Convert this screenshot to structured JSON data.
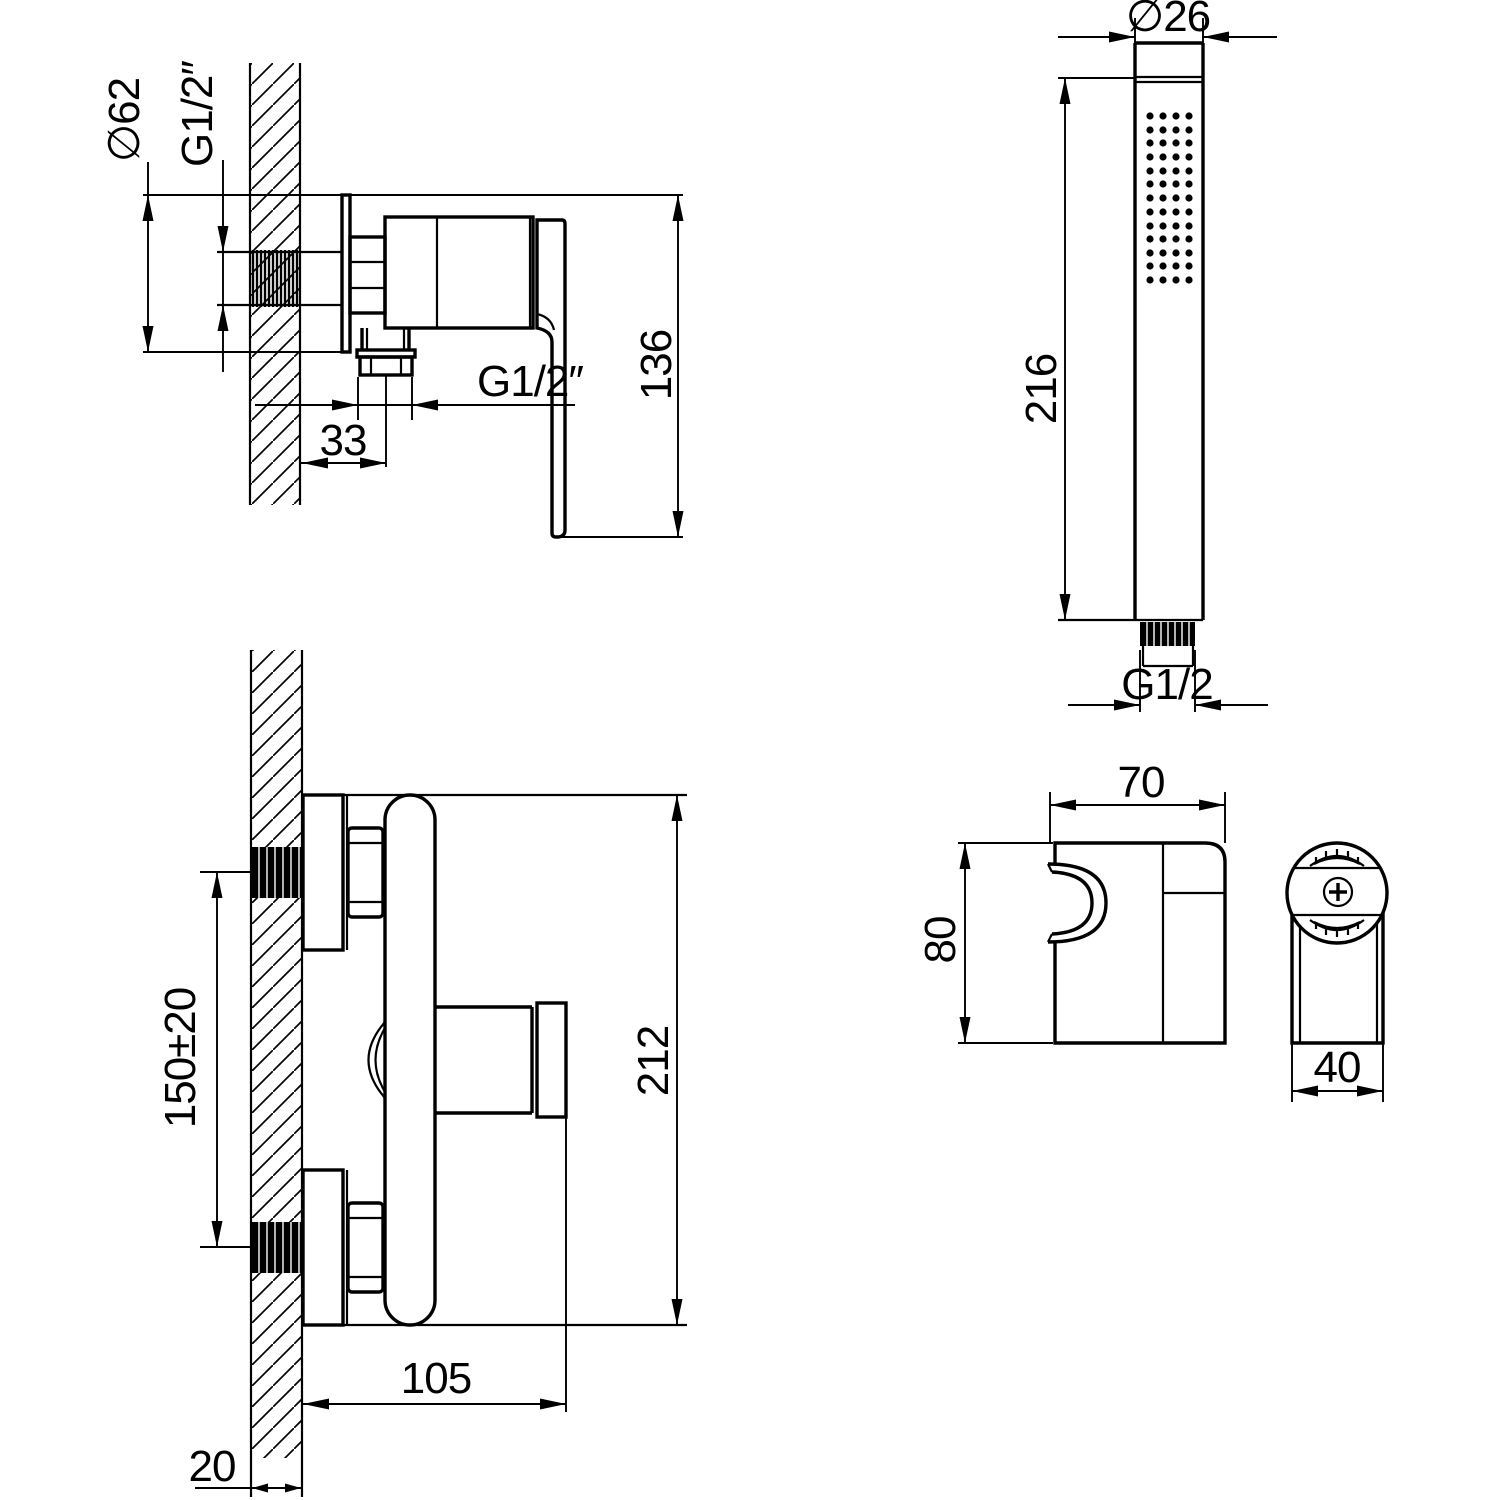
{
  "colors": {
    "line": "#000000",
    "background": "#ffffff"
  },
  "views": {
    "mixer_side": {
      "dims": {
        "diameter": "∅62",
        "inlet_thread": "G1/2″",
        "outlet_thread": "G1/2″",
        "outlet_offset": "33",
        "height": "136"
      }
    },
    "mixer_front": {
      "dims": {
        "inlet_spacing": "150±20",
        "height": "212",
        "reach": "105",
        "wall_thickness": "20"
      }
    },
    "hand_shower": {
      "dims": {
        "diameter": "∅26",
        "length": "216",
        "thread": "G1/2"
      }
    },
    "bracket": {
      "dims": {
        "width": "70",
        "height": "80",
        "depth": "40"
      }
    }
  }
}
